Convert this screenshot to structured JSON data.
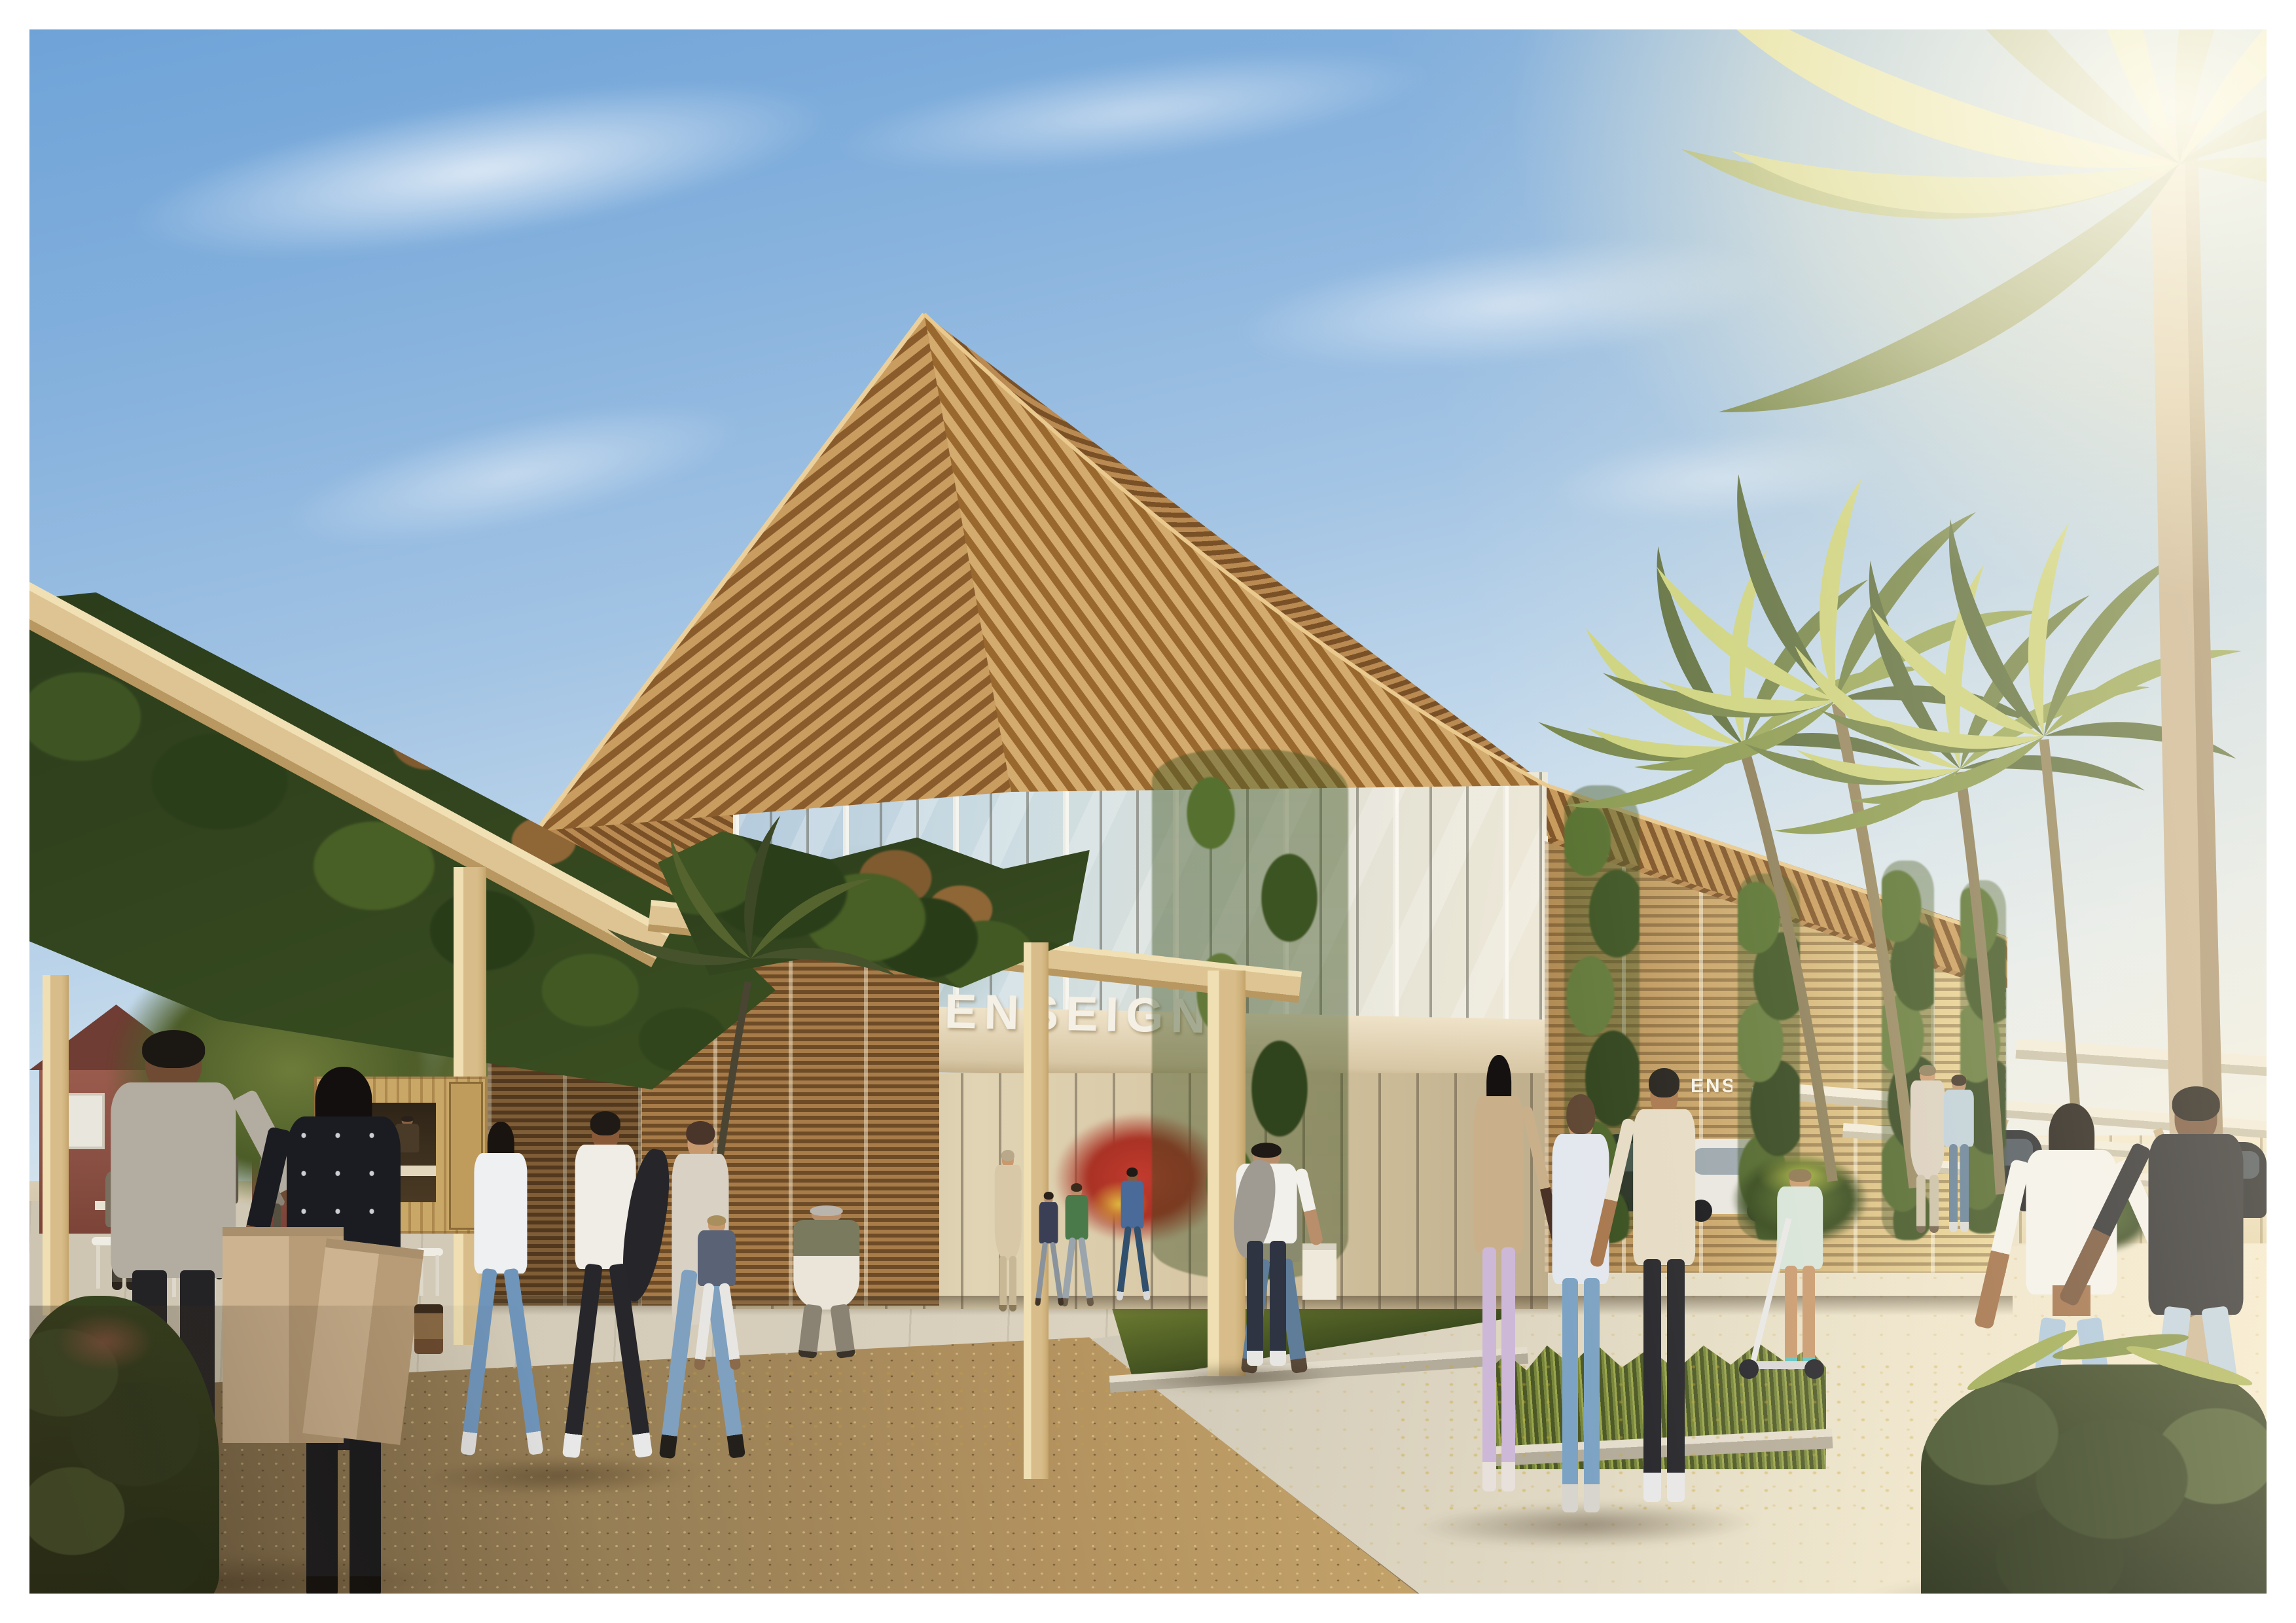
{
  "signage": {
    "main_storefront": "ENSEIGNE",
    "wing_sign_a": "ENSEIGNE",
    "wing_sign_b": "ENSEIGNE",
    "far_entrance_sign": "ENSEIGNE"
  },
  "palette": {
    "sky_top": "#6fa3d8",
    "sun_glow": "#fff6dd",
    "roof_wood_light": "#d4ab6e",
    "roof_wood_dark": "#8a5c2c",
    "facade_wood": "#c8a468",
    "glass_reflection": "#cfe0ee",
    "signage_white": "#f4f0e6",
    "foliage_dark": "#2f3d1f",
    "foliage_sunlit": "#9aa84f",
    "gravel_path": "#9a8157",
    "pavement_light": "#e9e2cd",
    "brick_house": "#94584a",
    "palm_trunk": "#c9b494"
  }
}
